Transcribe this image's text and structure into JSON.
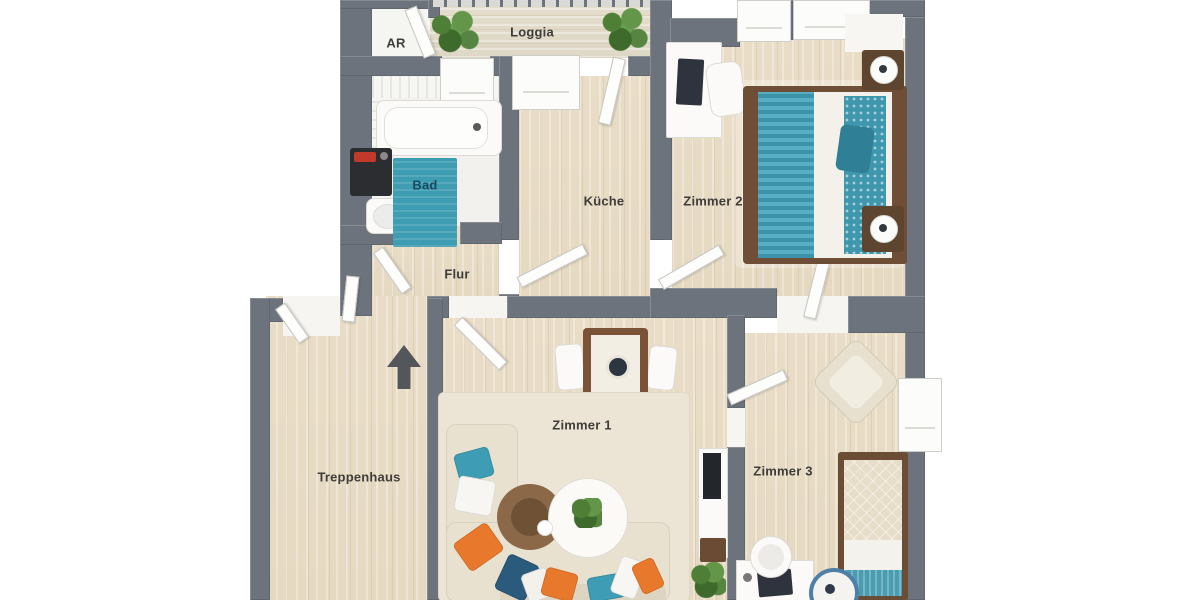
{
  "floorplan": {
    "type": "apartment-floor-plan-3d-top-view",
    "rooms": [
      {
        "id": "ar",
        "label": "AR"
      },
      {
        "id": "loggia",
        "label": "Loggia"
      },
      {
        "id": "bad",
        "label": "Bad"
      },
      {
        "id": "kueche",
        "label": "Küche"
      },
      {
        "id": "zimmer2",
        "label": "Zimmer 2"
      },
      {
        "id": "flur",
        "label": "Flur"
      },
      {
        "id": "treppenhaus",
        "label": "Treppenhaus"
      },
      {
        "id": "zimmer1",
        "label": "Zimmer 1"
      },
      {
        "id": "zimmer3",
        "label": "Zimmer 3"
      }
    ],
    "symbols": [
      {
        "id": "entrance-arrow",
        "meaning": "entrance direction indicator in Treppenhaus"
      }
    ],
    "furniture": [
      "bathtub",
      "washing-machine",
      "bathroom-sink",
      "bath-mat",
      "double-bed",
      "nightstand-with-lamp",
      "desk",
      "desk-chair",
      "balcony-plant",
      "dining-table",
      "dining-chair",
      "corner-sofa",
      "throw-pillows",
      "wicker-coffee-table",
      "white-side-table",
      "tv-sideboard",
      "area-rug",
      "armchair",
      "single-bed",
      "round-rug",
      "potted-plant"
    ],
    "colors": {
      "wall": "#6d737c",
      "wood_floor": "#e8dcc6",
      "loggia_floor": "#e1dac9",
      "accent_teal": "#3f9db3",
      "accent_orange": "#e8792c",
      "accent_navy": "#2a5a7c",
      "label_text": "#3f3d3a",
      "bad_label_text": "#174c5e"
    }
  }
}
